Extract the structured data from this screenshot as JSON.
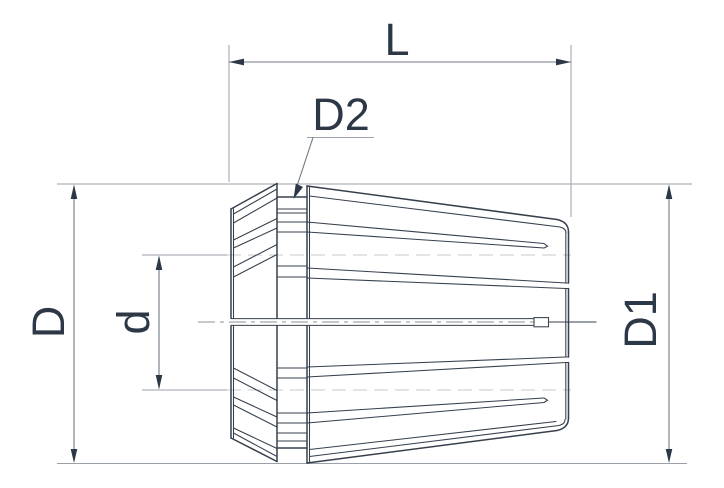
{
  "labels": {
    "length": "L",
    "groove_diameter": "D2",
    "overall_diameter": "D",
    "bore_diameter": "d",
    "front_diameter": "D1"
  },
  "colors": {
    "background": "#ffffff",
    "line": "#36404d",
    "dimension": "#707a84",
    "extension": "#9aa1a8",
    "guide_dashed": "#c4c8cc",
    "text": "#2c3845",
    "centerline": "#8b939a"
  }
}
